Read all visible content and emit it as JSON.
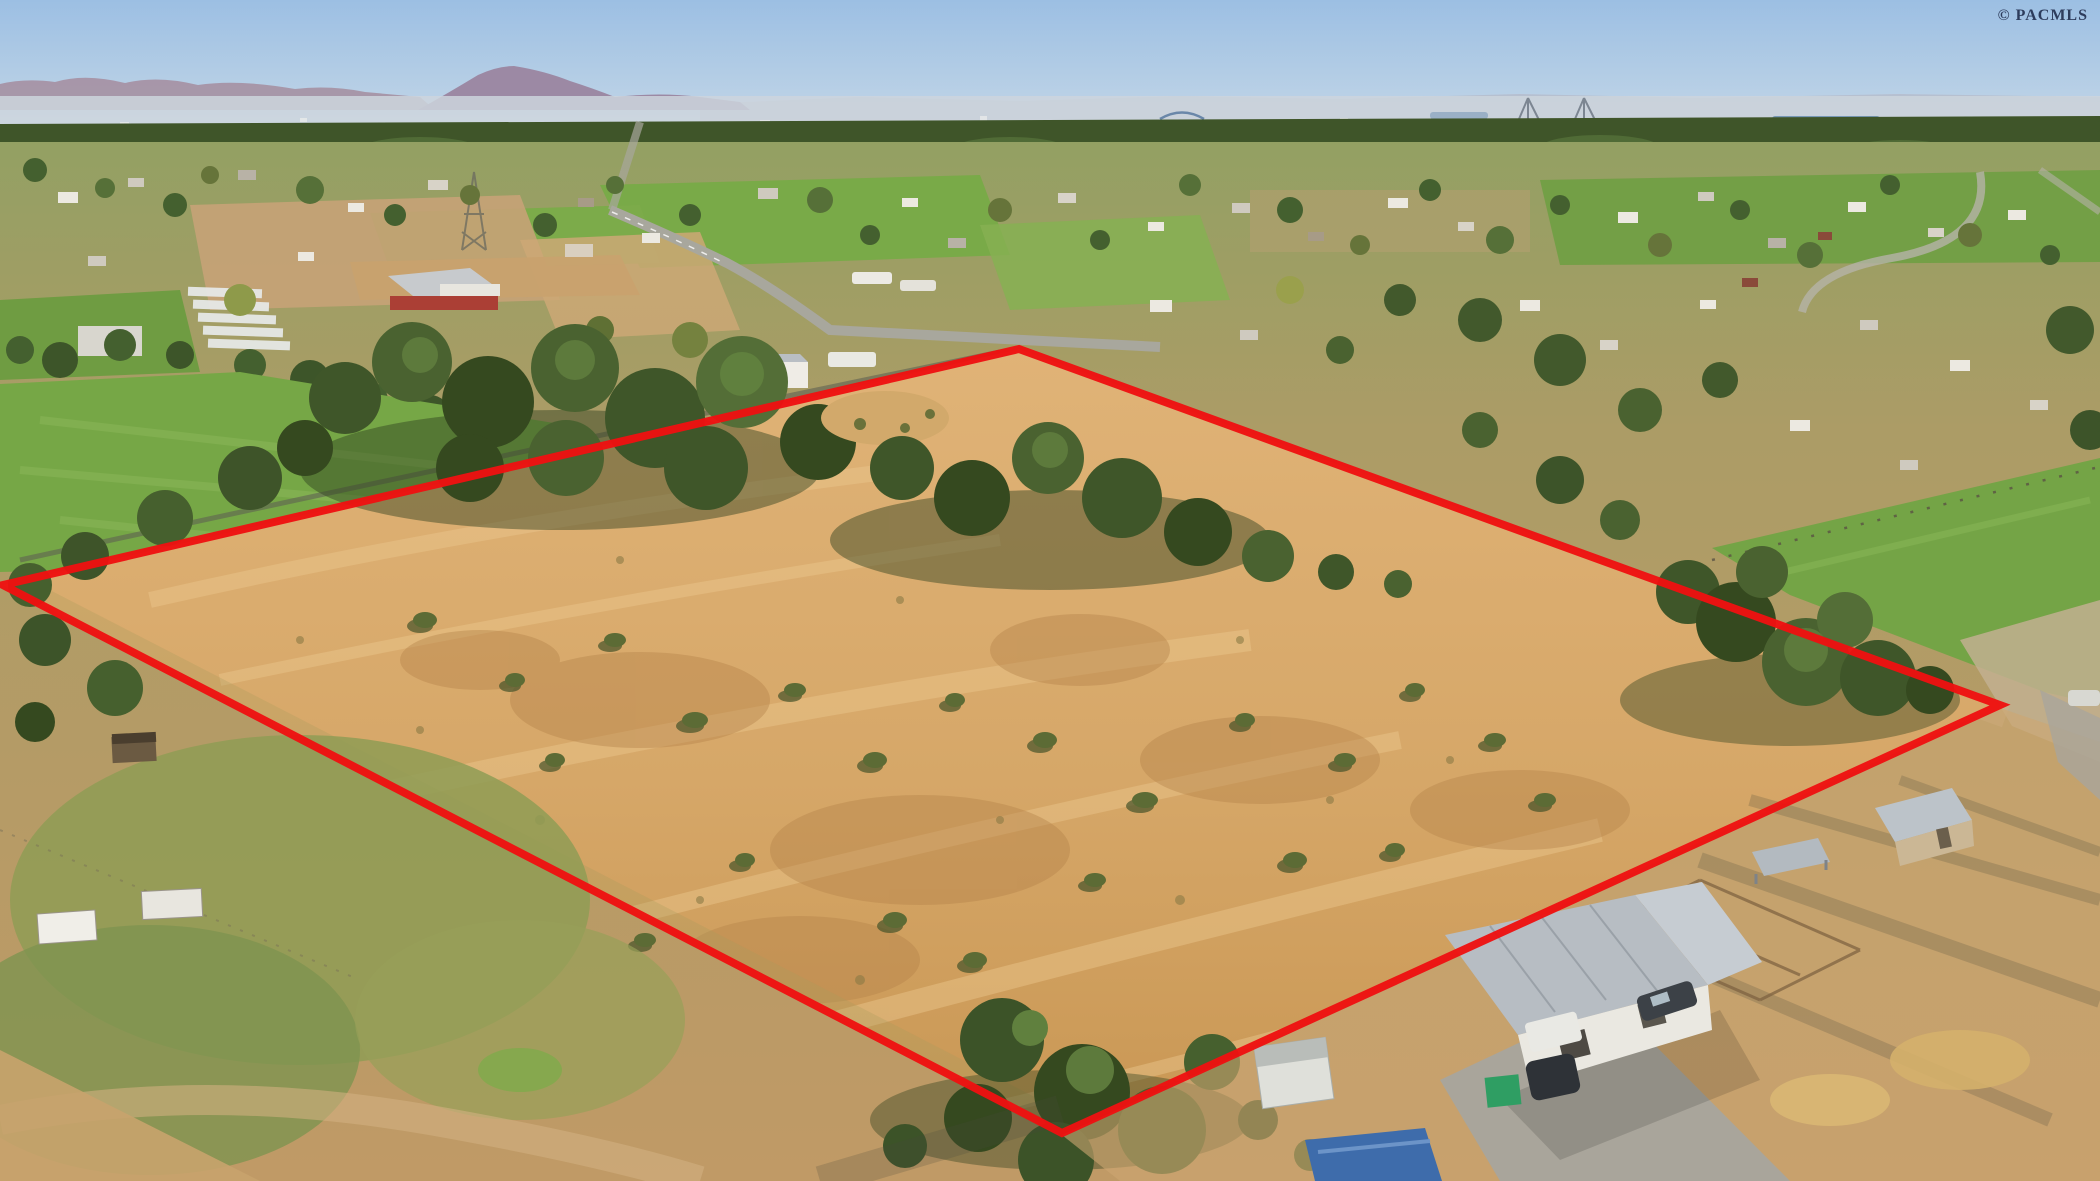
{
  "image": {
    "kind": "aerial-drone-real-estate-photo",
    "subject": "vacant dry-grass land parcel outlined with a red boundary overlay",
    "setting": "semi-rural valley; distant purple mountain, hazy city skyline with cable-stayed bridge and river on horizon; green pastures, scattered homes, red barn, greenhouses; farmstead with metal-roof shop, sheds, vehicles and corrals at lower right"
  },
  "watermark": {
    "text": "© PACMLS",
    "color": "#1e2a4a"
  },
  "boundary": {
    "color": "#ee1111",
    "stroke_width": 8,
    "vertices": [
      {
        "x": 3,
        "y": 585
      },
      {
        "x": 1019,
        "y": 349
      },
      {
        "x": 2000,
        "y": 705
      },
      {
        "x": 1062,
        "y": 1133
      }
    ]
  },
  "palette": {
    "sky_top": "#9cbfe3",
    "sky_horizon": "#dce6ee",
    "mountains": "#9c89a4",
    "city_haze": "#ccd5dd",
    "tree_band": "#3f5529",
    "green_field": "#76a746",
    "dry_grass": "#d6a768",
    "dirt": "#c49a66",
    "roof_gray": "#b7bdc3",
    "building_white": "#eae8e1"
  },
  "regions": [
    "sky",
    "purple-mountain-left-horizon",
    "distant-city-haze-with-cable-bridge-and-river",
    "background-tree-band",
    "midground-fields-homes-red-barn-greenhouses",
    "left-green-pasture",
    "subject-parcel-dry-golden-grass-with-tree-groves",
    "right-green-pasture",
    "bottom-left-pasture-with-small-sheds",
    "bottom-right-farmstead-shop-sheds-vehicles"
  ]
}
